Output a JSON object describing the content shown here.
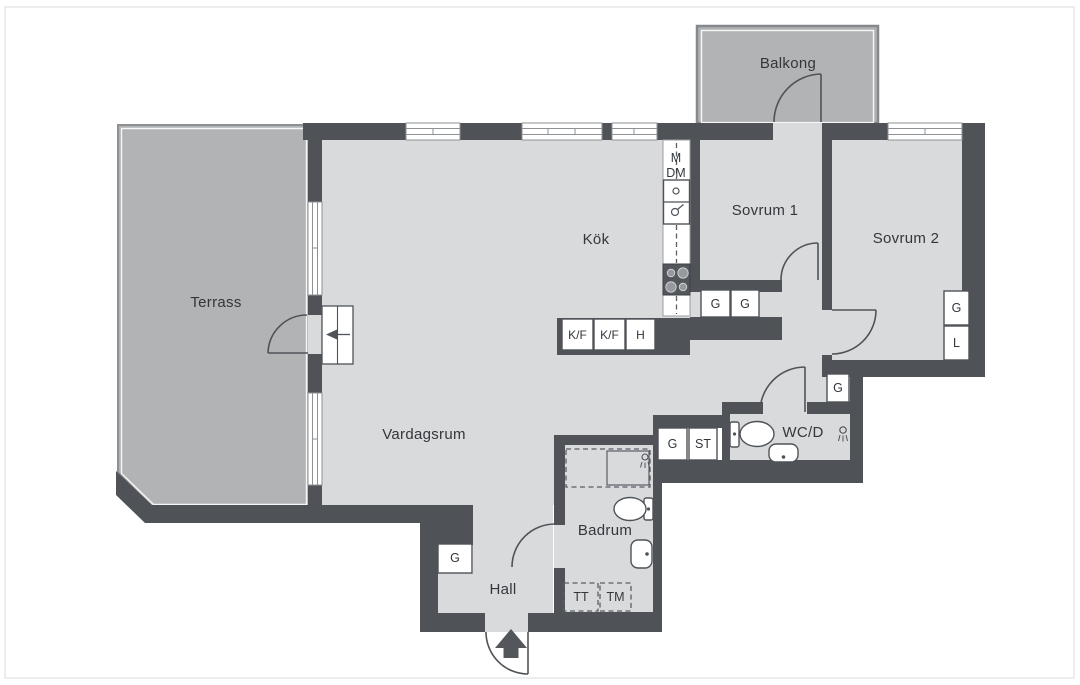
{
  "title": "Apartment floor plan",
  "rooms": {
    "terrass": "Terrass",
    "balkong": "Balkong",
    "kok": "Kök",
    "sovrum1": "Sovrum 1",
    "sovrum2": "Sovrum 2",
    "vardagsrum": "Vardagsrum",
    "wcd": "WC/D",
    "badrum": "Badrum",
    "hall": "Hall"
  },
  "kitchen": {
    "m": "M",
    "dm": "DM",
    "kf1": "K/F",
    "kf2": "K/F",
    "h": "H"
  },
  "closets": {
    "sovrum1_g1": "G",
    "sovrum1_g2": "G",
    "sovrum2_g": "G",
    "sovrum2_l": "L",
    "wcd_g": "G",
    "corridor_g": "G",
    "corridor_st": "ST",
    "hall_g": "G"
  },
  "laundry": {
    "tt": "TT",
    "tm": "TM"
  },
  "colors": {
    "wall": "#4f5358",
    "floor": "#d9dadc",
    "outdoor": "#b1b3b5",
    "text": "#33373b",
    "background": "#ffffff"
  }
}
